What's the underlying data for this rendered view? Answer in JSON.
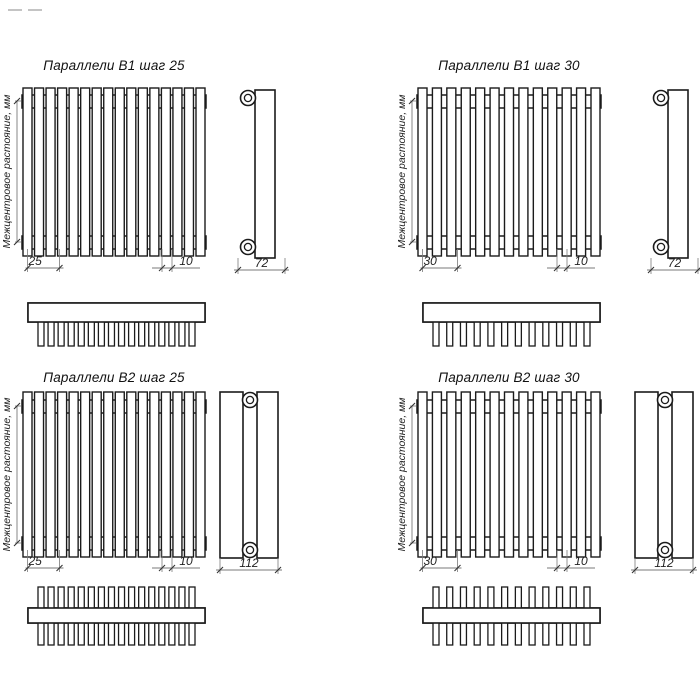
{
  "page": {
    "background": "#ffffff"
  },
  "drawing": {
    "axis_label": "Межцентровое растояние, мм",
    "units": "мм",
    "colors": {
      "line": "#1b1b1b",
      "dim_line": "#7a7a7a",
      "tick": "#333333",
      "text": "#222222",
      "bg": "#ffffff"
    },
    "panels": [
      {
        "title": "Параллели В1 шаг 25",
        "pitch_label": "25",
        "end_label": "10",
        "depth_label": "72",
        "rows": 1,
        "front_tubes": 16,
        "bottom_stubs": 16
      },
      {
        "title": "Параллели В1 шаг 30",
        "pitch_label": "30",
        "end_label": "10",
        "depth_label": "72",
        "rows": 1,
        "front_tubes": 13,
        "bottom_stubs": 12
      },
      {
        "title": "Параллели В2 шаг 25",
        "pitch_label": "25",
        "end_label": "10",
        "depth_label": "112",
        "rows": 2,
        "front_tubes": 16,
        "bottom_stubs": 16
      },
      {
        "title": "Параллели В2 шаг 30",
        "pitch_label": "30",
        "end_label": "10",
        "depth_label": "112",
        "rows": 2,
        "front_tubes": 13,
        "bottom_stubs": 12
      }
    ]
  }
}
